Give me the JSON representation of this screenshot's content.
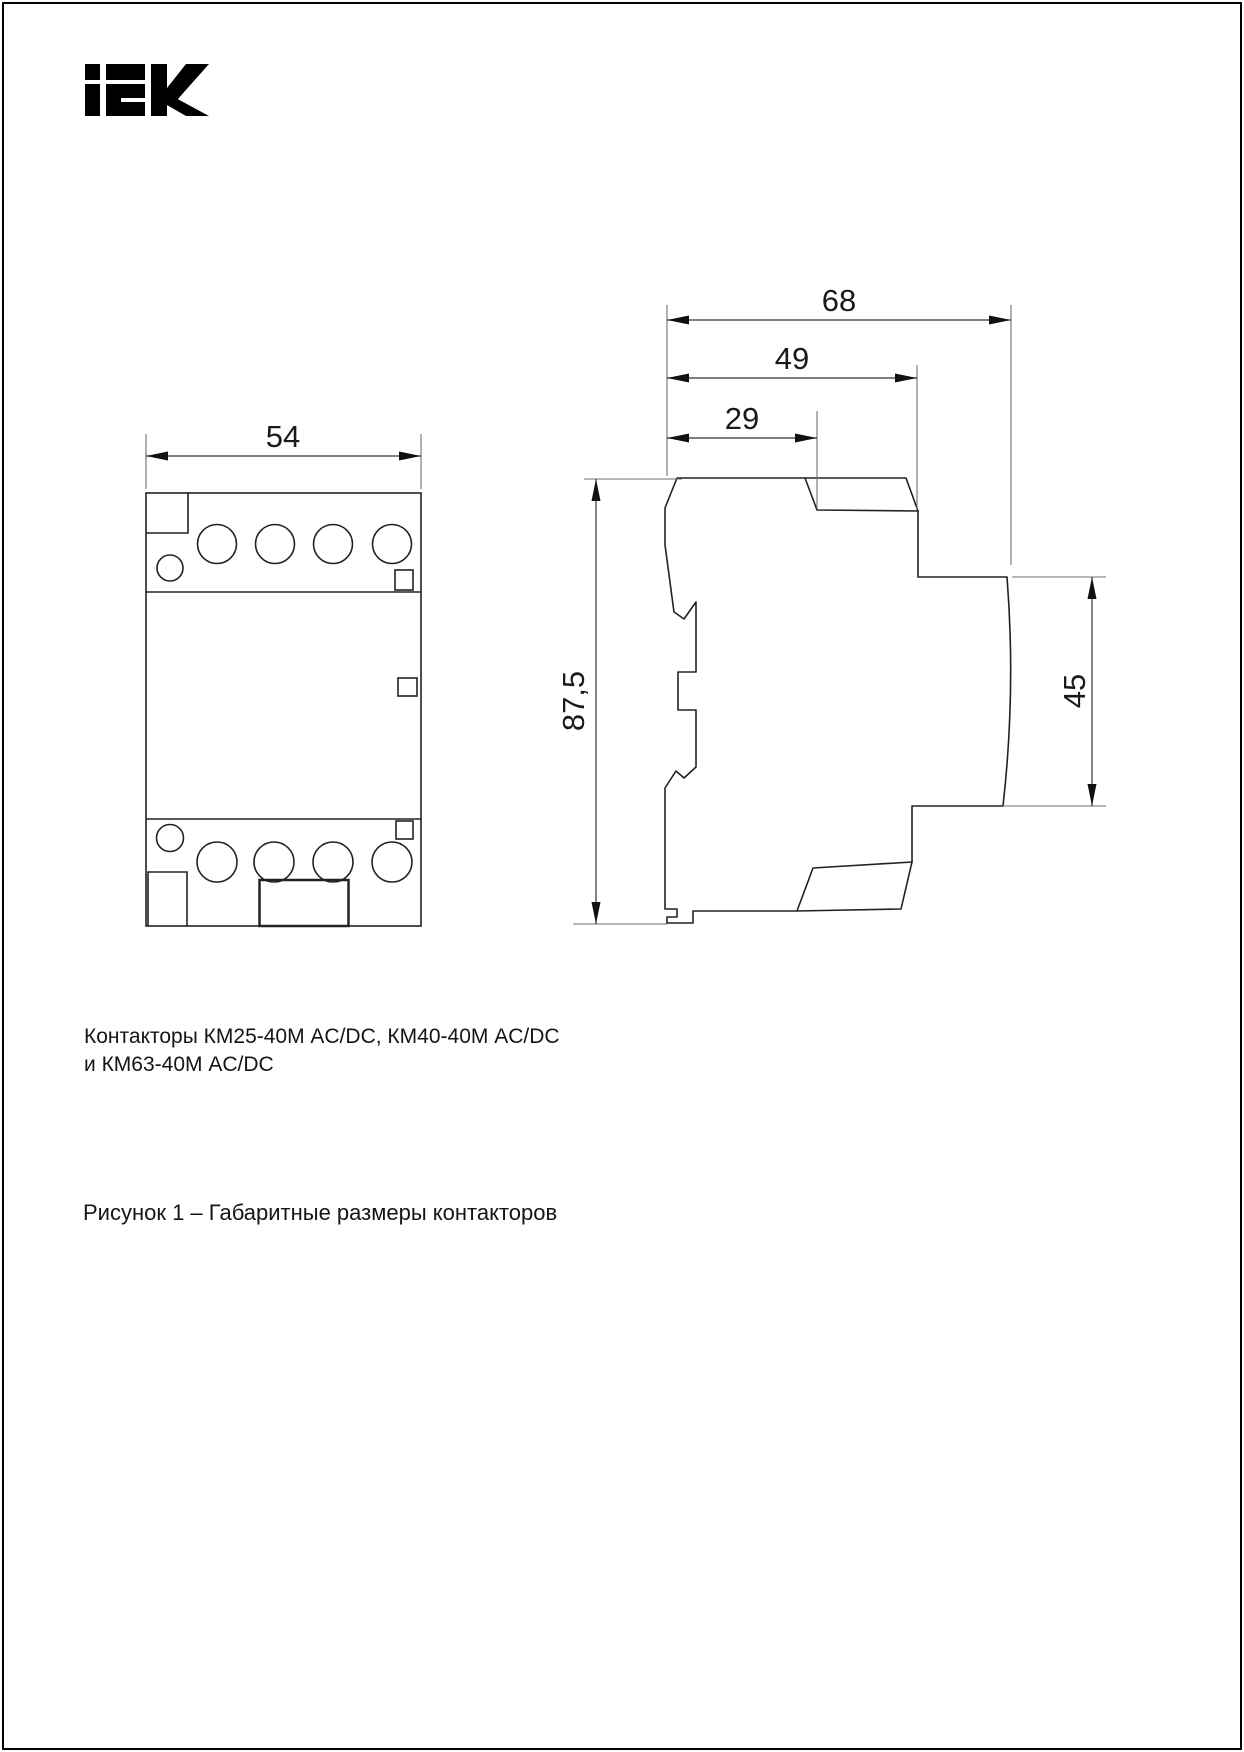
{
  "logo": {
    "brand": "iEK",
    "color": "#000000"
  },
  "dimensions": {
    "front_width": "54",
    "side_depth_total": "68",
    "side_depth_body": "49",
    "side_depth_top": "29",
    "side_height_total": "87,5",
    "side_front_height": "45"
  },
  "captions": {
    "line1": "Контакторы КМ25-40М AC/DC, КМ40-40М AC/DC",
    "line2": "и КМ63-40М AC/DC",
    "figure_label": "Рисунок 1 – Габаритные размеры контакторов"
  },
  "colors": {
    "outline": "#222222",
    "dimension_line": "#333333",
    "extension_line": "#6e6e6e",
    "arrow": "#111111"
  }
}
